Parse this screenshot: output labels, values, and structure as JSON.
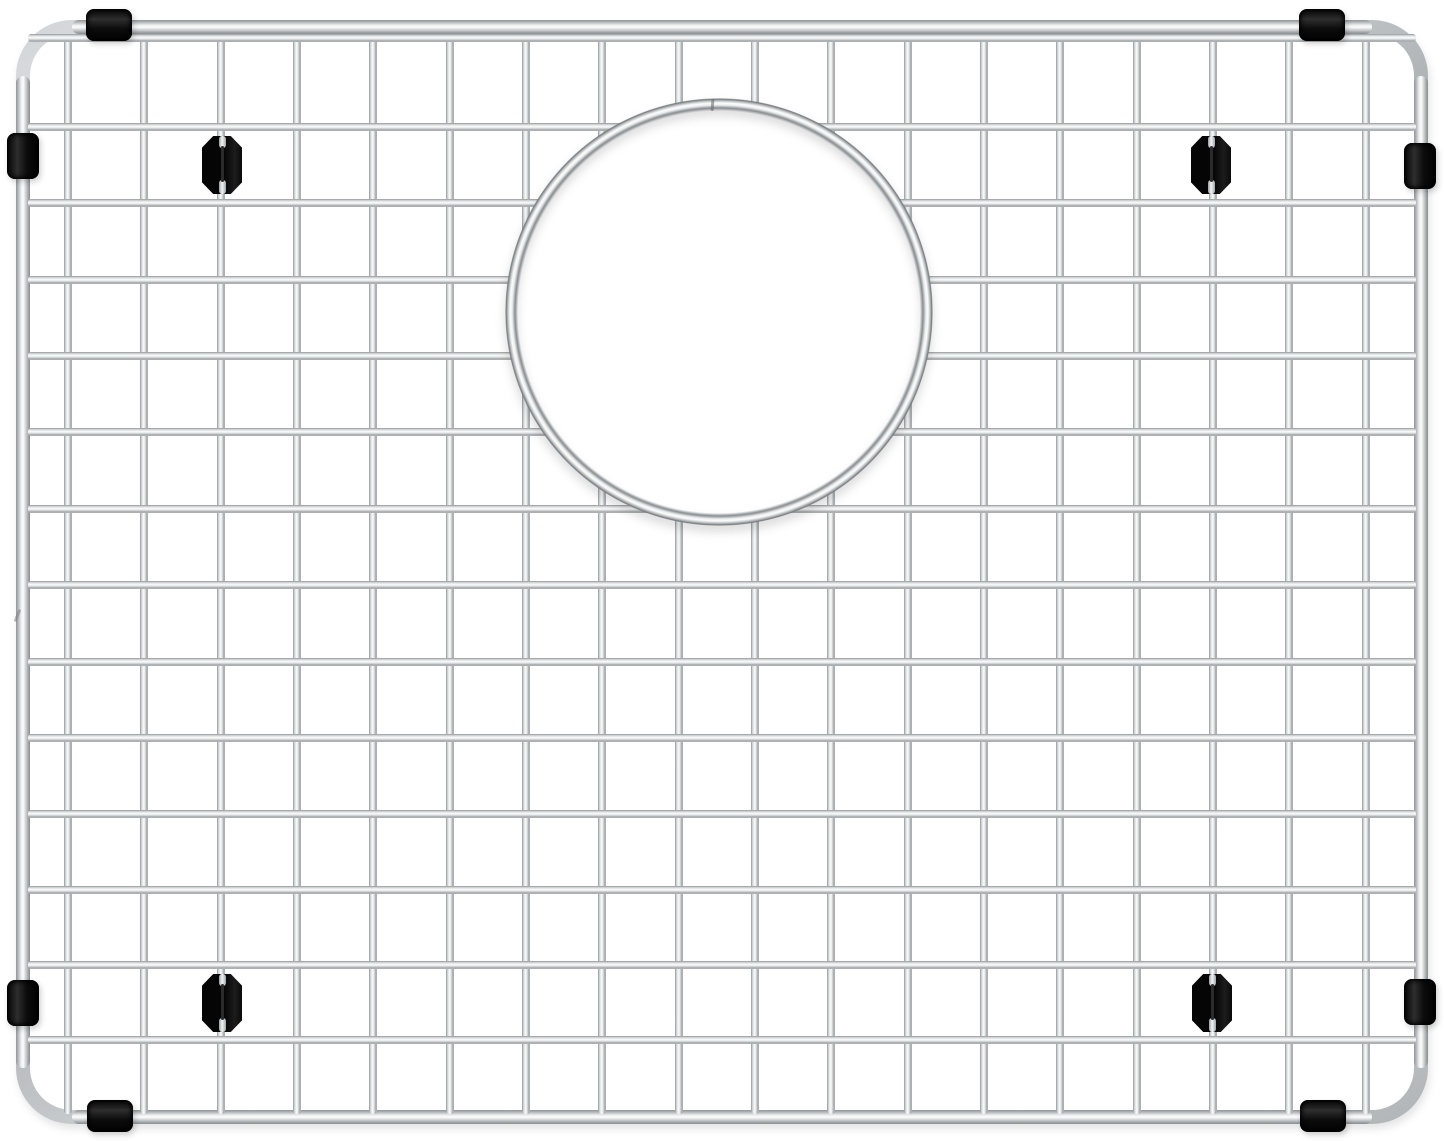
{
  "canvas": {
    "width": 1444,
    "height": 1141,
    "background": "#ffffff"
  },
  "product": {
    "kind": "stainless-steel-sink-bottom-grid",
    "steel_highlight": "#f7f8f8",
    "steel_shadow": "#8f9497",
    "rubber_color": "#0a0a0a"
  },
  "frame": {
    "left": 16,
    "top": 20,
    "right": 1428,
    "bottom": 1124,
    "tube": 14,
    "corner_radius": 56
  },
  "grid": {
    "wire_thickness": 8,
    "vertical_wire_x": [
      68,
      144,
      221,
      297,
      373,
      450,
      526,
      602,
      679,
      755,
      831,
      908,
      984,
      1060,
      1137,
      1213,
      1289,
      1366
    ],
    "horizontal_wire_y": [
      38,
      127,
      203,
      280,
      356,
      432,
      509,
      585,
      662,
      738,
      814,
      890,
      965,
      1040
    ],
    "vertical_wire_top": 36,
    "vertical_wire_bottom": 1114,
    "horizontal_wire_left": 28,
    "horizontal_wire_right": 1416
  },
  "ring": {
    "cx": 719,
    "cy": 312,
    "outer_radius": 214,
    "clip_radius": 207,
    "seam": {
      "x": 711,
      "y": 99
    }
  },
  "details": {
    "frame_joint": {
      "x": 16,
      "y": 609
    }
  },
  "bumpers": {
    "sleeve_length": 46,
    "sleeve_thickness": 32,
    "edge_sleeves": [
      {
        "id": "sleeve-top-left",
        "orientation": "horizontal",
        "cx": 109,
        "cy": 25
      },
      {
        "id": "sleeve-top-right",
        "orientation": "horizontal",
        "cx": 1322,
        "cy": 25
      },
      {
        "id": "sleeve-bottom-left",
        "orientation": "horizontal",
        "cx": 110,
        "cy": 1116
      },
      {
        "id": "sleeve-bottom-right",
        "orientation": "horizontal",
        "cx": 1323,
        "cy": 1116
      },
      {
        "id": "sleeve-left-upper",
        "orientation": "vertical",
        "cx": 23,
        "cy": 156
      },
      {
        "id": "sleeve-left-lower",
        "orientation": "vertical",
        "cx": 23,
        "cy": 1003
      },
      {
        "id": "sleeve-right-upper",
        "orientation": "vertical",
        "cx": 1420,
        "cy": 166
      },
      {
        "id": "sleeve-right-lower",
        "orientation": "vertical",
        "cx": 1420,
        "cy": 1002
      }
    ],
    "foot_width": 40,
    "foot_height": 58,
    "feet": [
      {
        "id": "foot-top-left",
        "cx": 222,
        "cy": 165
      },
      {
        "id": "foot-top-right",
        "cx": 1211,
        "cy": 165
      },
      {
        "id": "foot-bottom-left",
        "cx": 222,
        "cy": 1003
      },
      {
        "id": "foot-bottom-right",
        "cx": 1212,
        "cy": 1003
      }
    ]
  }
}
